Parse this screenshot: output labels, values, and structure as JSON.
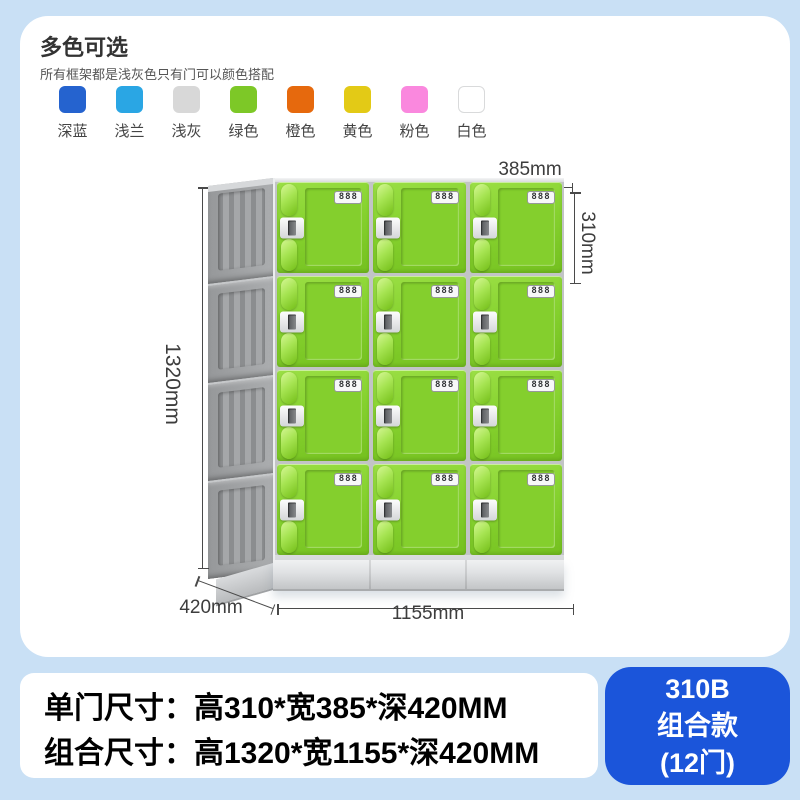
{
  "theme": {
    "page_bg": "#c9e0f5",
    "card_bg": "#ffffff",
    "accent_blue": "#1b55da",
    "door_green": "#86d22f",
    "frame_gray": "#a6a8aa",
    "dim_color": "#4a4a4a"
  },
  "color_section": {
    "title": "多色可选",
    "subtitle": "所有框架都是浅灰色只有门可以颜色搭配",
    "swatches": [
      {
        "label": "深蓝",
        "hex": "#2563cf"
      },
      {
        "label": "浅兰",
        "hex": "#2aa6e4"
      },
      {
        "label": "浅灰",
        "hex": "#d8d8d8"
      },
      {
        "label": "绿色",
        "hex": "#7dc827"
      },
      {
        "label": "橙色",
        "hex": "#e6690d"
      },
      {
        "label": "黄色",
        "hex": "#e3ca16"
      },
      {
        "label": "粉色",
        "hex": "#fa88de"
      },
      {
        "label": "白色",
        "hex": "#ffffff",
        "border": true
      }
    ]
  },
  "locker": {
    "rows": 4,
    "cols": 3,
    "door_count": 12,
    "lock_text": "888"
  },
  "dimensions": {
    "total_height": "1320mm",
    "door_width": "385mm",
    "door_height": "310mm",
    "depth": "420mm",
    "total_width": "1155mm"
  },
  "specs": {
    "line1": "单门尺寸：高310*宽385*深420MM",
    "line2": "组合尺寸：高1320*宽1155*深420MM"
  },
  "badge": {
    "model": "310B",
    "type": "组合款",
    "doors": "(12门)"
  }
}
